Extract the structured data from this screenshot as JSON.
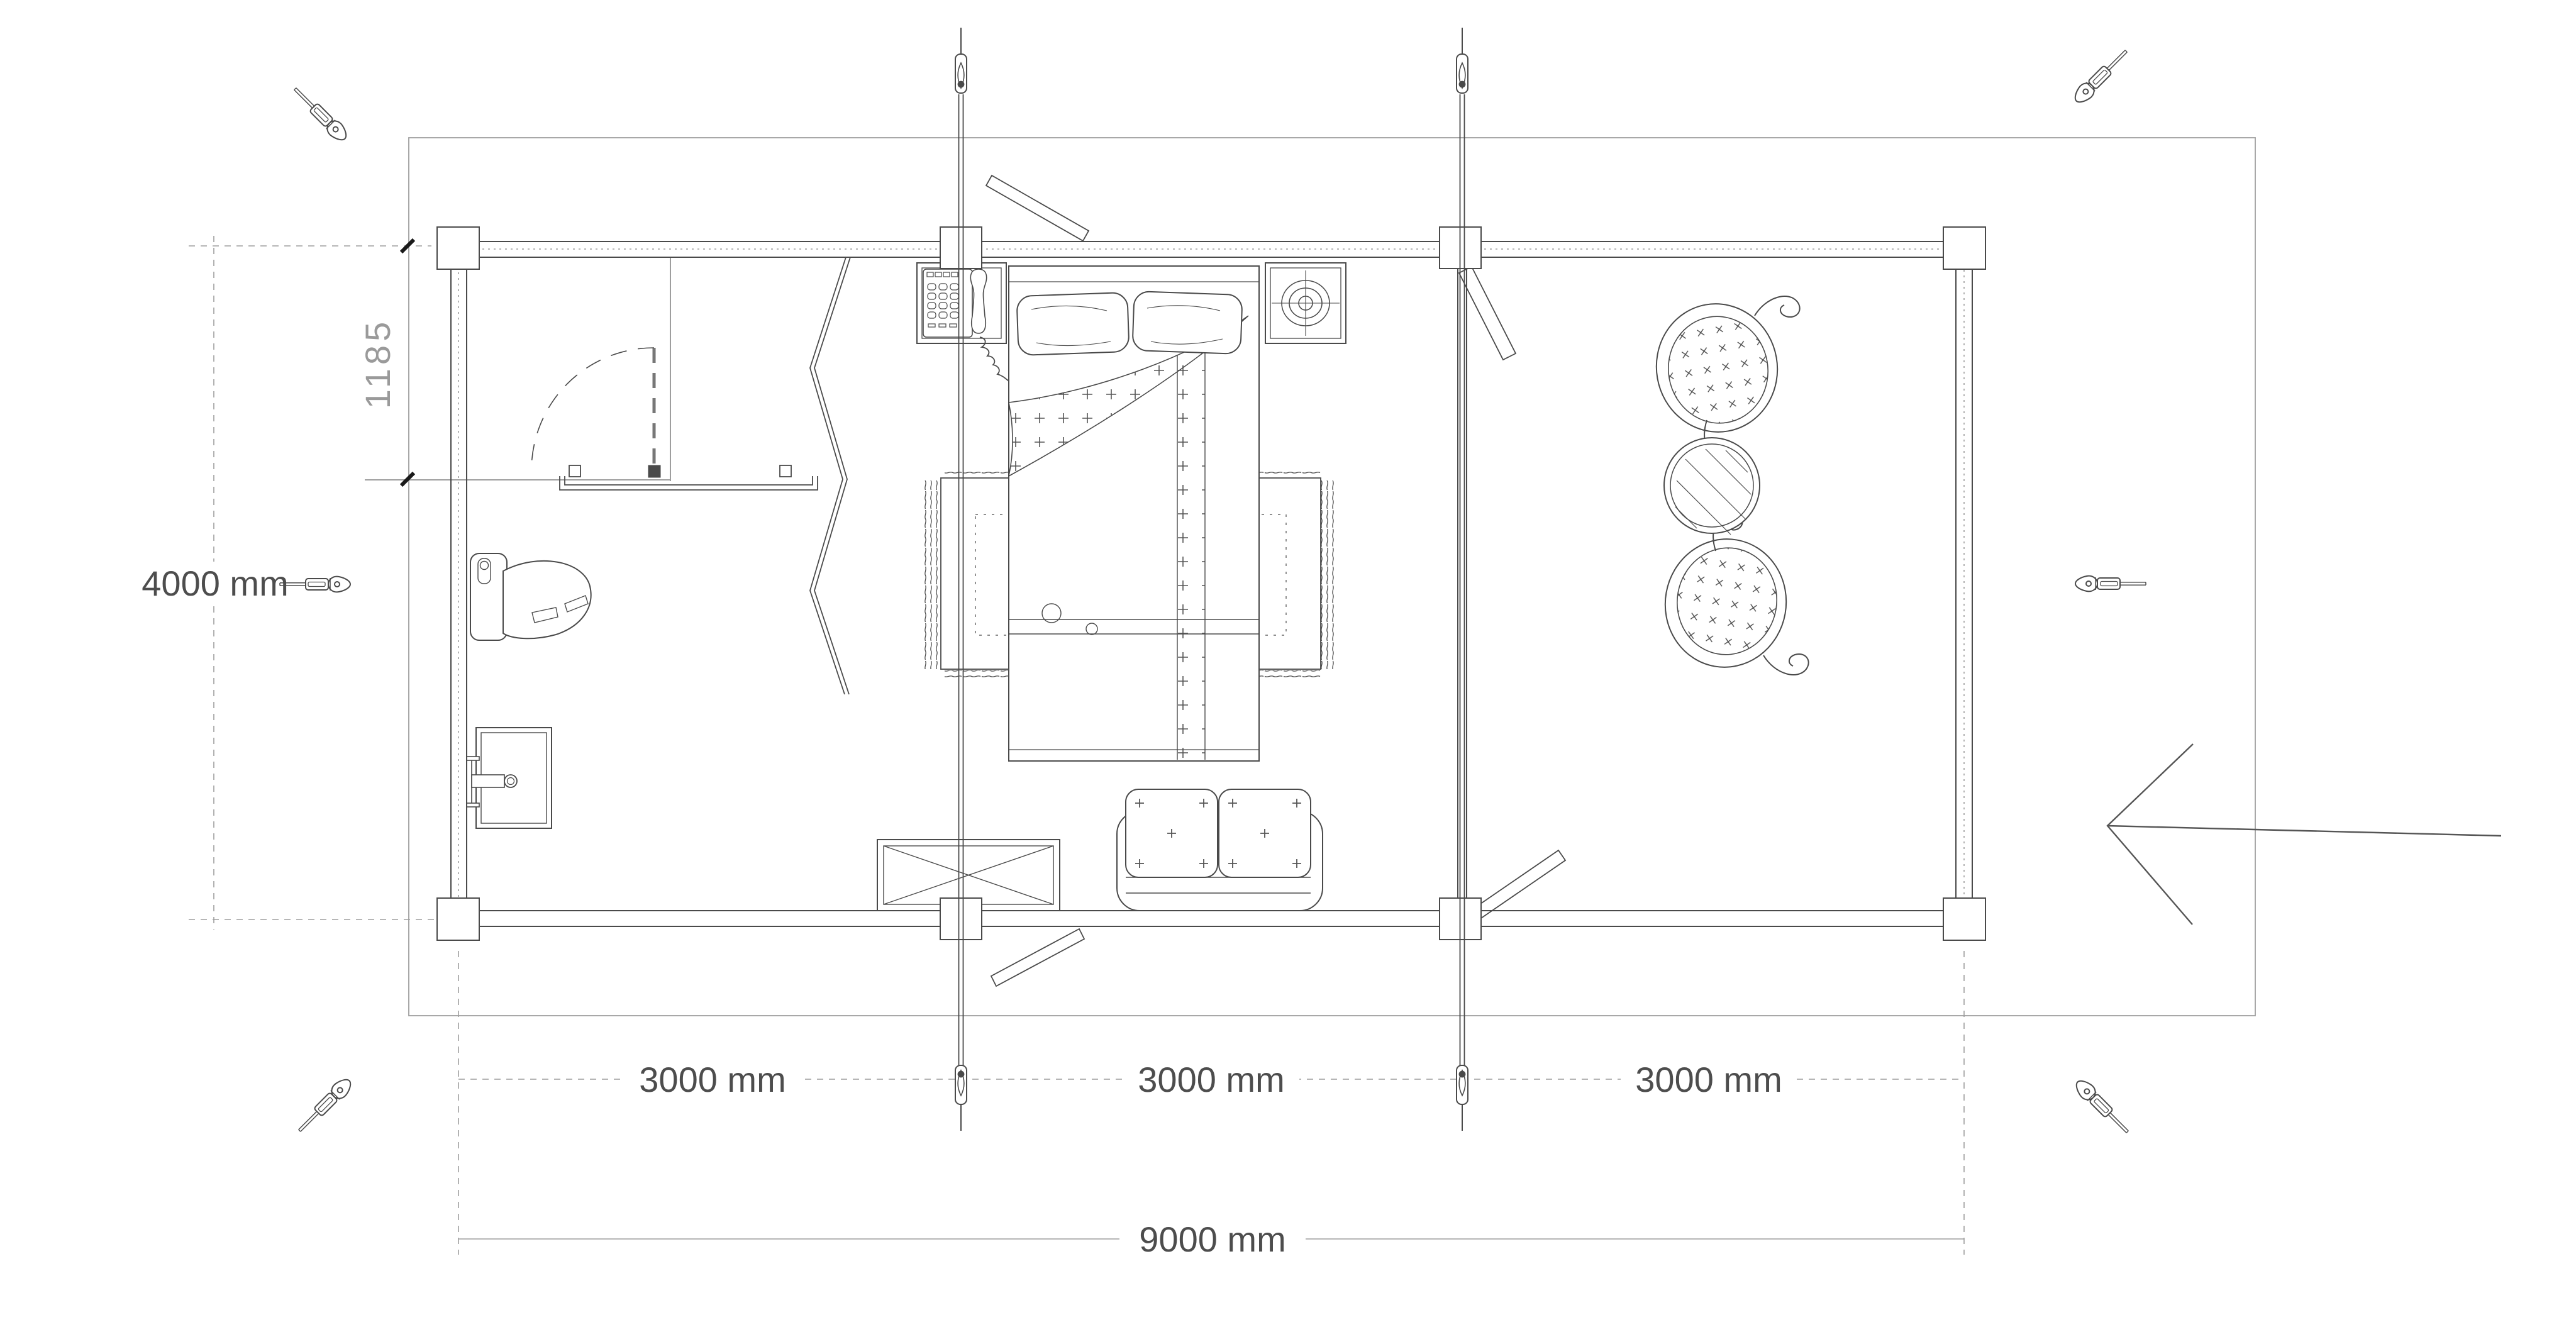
{
  "page": {
    "background": "#ffffff"
  },
  "dimensions": {
    "bathroom_depth_label": "1185",
    "building_depth_label": "4000 mm",
    "module_labels": [
      "3000 mm",
      "3000 mm",
      "3000 mm"
    ],
    "building_width_label": "9000 mm"
  },
  "colors": {
    "line_dark": "#4a4a4a",
    "line_light": "#9e9e9e",
    "dimension_text": "#4d4d4d",
    "secondary_text": "#9a9a9a",
    "background": "#ffffff"
  },
  "icons": {
    "corner_brace": "turnbuckle-icon",
    "tie_rod_anchor": "tie-rod-anchor-icon",
    "entrance": "entrance-arrow-icon"
  }
}
